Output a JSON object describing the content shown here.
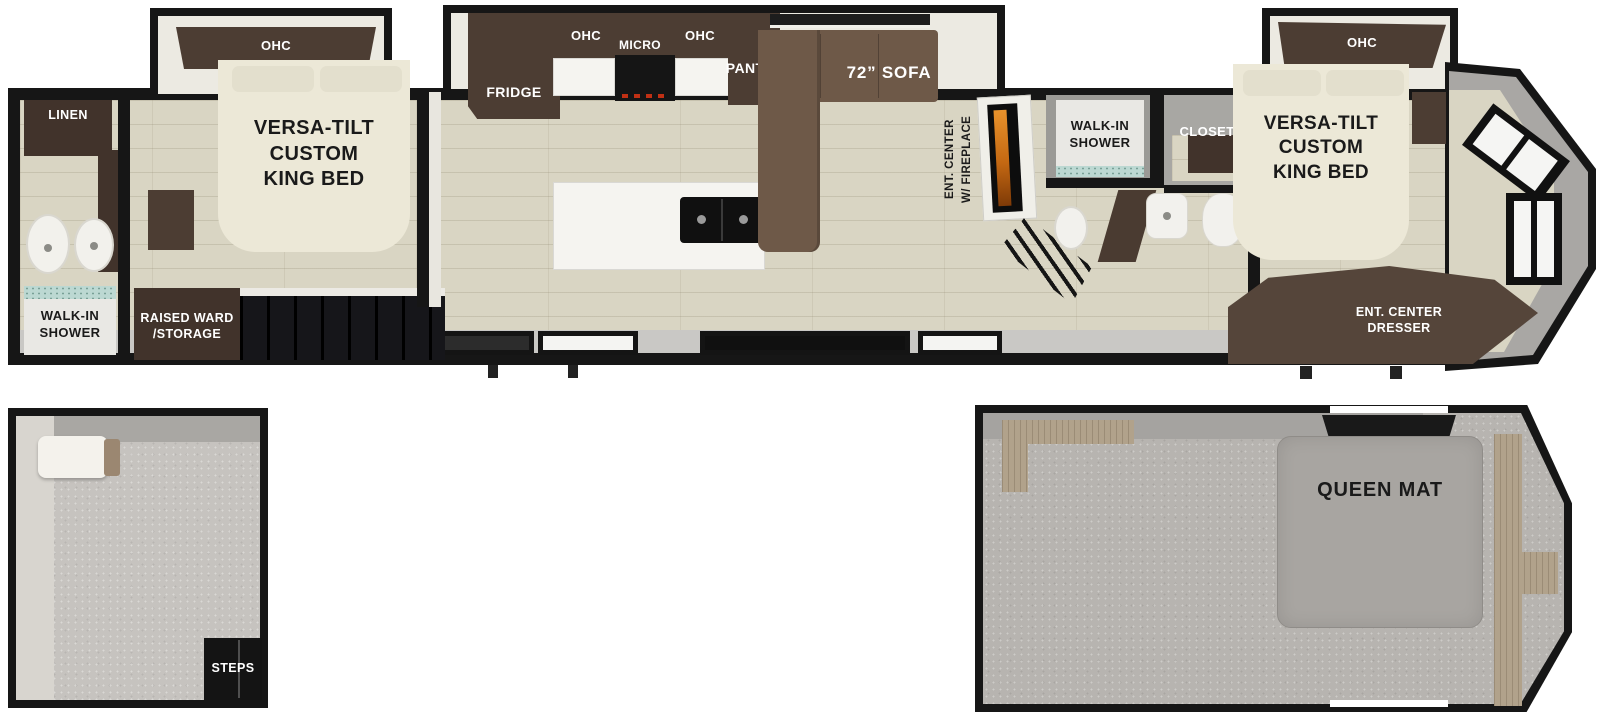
{
  "title": "RV destination trailer floor plan with loft",
  "colors": {
    "wall": "#161616",
    "wood_floor": "#d9d5c3",
    "cabinet_brown": "#4c3d33",
    "sofa_brown": "#6e5948",
    "bed_cream": "#ece8d7",
    "carpet_gray": "#b7b4b0",
    "fireplace_flame": "#d97b1f"
  },
  "main_floor": {
    "rear_bath": {
      "linen_label": "LINEN",
      "shower_label": "WALK-IN\nSHOWER"
    },
    "rear_bedroom": {
      "ohc_label": "OHC",
      "bed_label": "VERSA-TILT\nCUSTOM\nKING BED",
      "storage_label": "RAISED WARD\n/STORAGE"
    },
    "kitchen": {
      "fridge_label": "FRIDGE",
      "ohc_left_label": "OHC",
      "micro_label": "MICRO",
      "ohc_right_label": "OHC",
      "pantry_label": "PANTRY"
    },
    "living": {
      "sofa_label": "72” SOFA",
      "ent_center_label": "ENT. CENTER\nW/ FIREPLACE"
    },
    "mid_bath": {
      "shower_label": "WALK-IN\nSHOWER",
      "closet_label": "CLOSET"
    },
    "front_bedroom": {
      "ohc_label": "OHC",
      "bed_label": "VERSA-TILT\nCUSTOM\nKING BED",
      "dresser_label": "ENT. CENTER\nDRESSER"
    }
  },
  "loft_rear": {
    "steps_label": "STEPS"
  },
  "loft_front": {
    "queen_mat_label": "QUEEN MAT"
  }
}
